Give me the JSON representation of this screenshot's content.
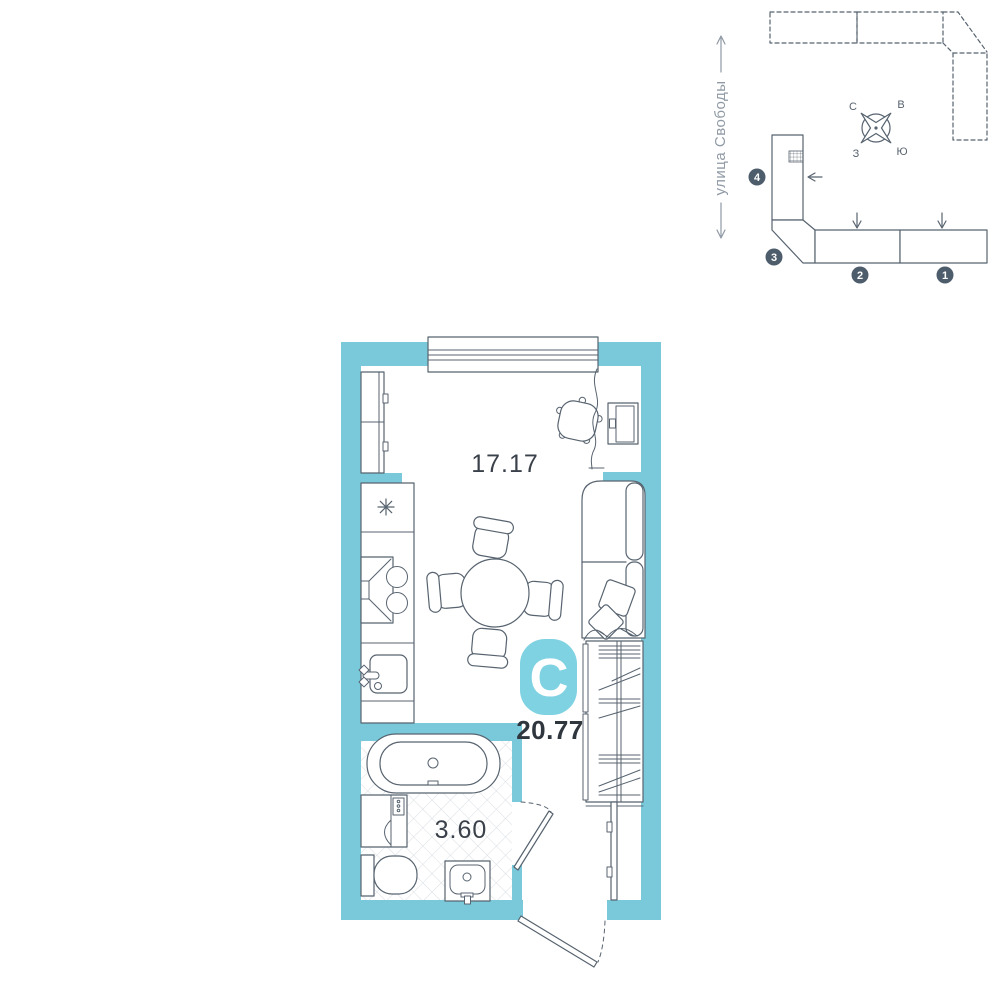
{
  "site_plan": {
    "street_label": "улица Свободы",
    "compass": {
      "n": "С",
      "e": "В",
      "w": "З",
      "s": "Ю"
    },
    "buildings": [
      {
        "number": "1"
      },
      {
        "number": "2"
      },
      {
        "number": "3"
      },
      {
        "number": "4"
      }
    ]
  },
  "floor_plan": {
    "unit_type_label": "С",
    "total_area": "20.77",
    "living_area": "17.17",
    "bathroom_area": "3.60"
  },
  "colors": {
    "wall": "#79c9da",
    "badge": "#7fd2e2",
    "outline": "#57636f",
    "marker": "#4e5d6c",
    "text_dark": "#2f363e",
    "street_gray": "#909aa5",
    "tile": "#d9dee3"
  }
}
